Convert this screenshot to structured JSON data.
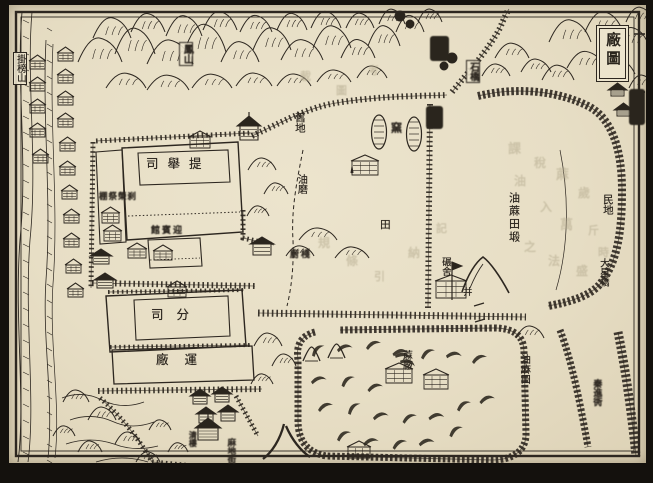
{
  "page": {
    "type": "woodblock-printed Chinese map, scanned book page",
    "paper_color": "#e9e1c8",
    "ink_color": "#2d2720",
    "title_box": {
      "text": "廠圖",
      "note": "map title cartouche, top-right corner"
    }
  },
  "labels": [
    {
      "id": "label-guabang-mountain",
      "t": "掛榜山",
      "x": 13,
      "y": 52,
      "o": "v",
      "s": 9.5,
      "box": true
    },
    {
      "id": "label-mountain-cartouche",
      "t": "鳳山",
      "x": 179,
      "y": 42,
      "o": "v",
      "s": 10,
      "box": true,
      "blur": true
    },
    {
      "id": "label-old-land",
      "t": "舊地",
      "x": 294,
      "y": 112,
      "o": "v",
      "s": 10.5
    },
    {
      "id": "label-oil-mill",
      "t": "油磨",
      "x": 295,
      "y": 174,
      "o": "v",
      "s": 10
    },
    {
      "id": "label-kiln",
      "t": "窯",
      "x": 390,
      "y": 122,
      "o": "v",
      "s": 11,
      "blur": true
    },
    {
      "id": "label-sesame-field-tract",
      "t": "油蔴田塅",
      "x": 508,
      "y": 192,
      "o": "v",
      "s": 11,
      "ls": 2
    },
    {
      "id": "label-roller-shed",
      "t": "碾舍",
      "x": 440,
      "y": 257,
      "o": "v",
      "s": 9.5
    },
    {
      "id": "label-well",
      "t": "井",
      "x": 461,
      "y": 287,
      "o": "v",
      "s": 9
    },
    {
      "id": "label-civilian-land",
      "t": "民地",
      "x": 602,
      "y": 194,
      "o": "v",
      "s": 10.5
    },
    {
      "id": "label-daxing-bridge",
      "t": "大星橋",
      "x": 598,
      "y": 258,
      "o": "v",
      "s": 9.5
    },
    {
      "id": "label-field",
      "t": "田",
      "x": 379,
      "y": 219,
      "o": "v",
      "s": 10.5
    },
    {
      "id": "label-hemp-factory",
      "t": "蔴廠",
      "x": 400,
      "y": 350,
      "o": "v",
      "s": 10
    },
    {
      "id": "label-sesame-field",
      "t": "油麻田",
      "x": 518,
      "y": 354,
      "o": "v",
      "s": 10
    },
    {
      "id": "label-qinjin-lane",
      "t": "秦進衖",
      "x": 591,
      "y": 379,
      "o": "v",
      "s": 9,
      "blur": true
    },
    {
      "id": "label-madi-street",
      "t": "麻地街",
      "x": 226,
      "y": 438,
      "o": "v",
      "s": 8.5,
      "blur": true
    },
    {
      "id": "label-ferry-tower",
      "t": "清樓",
      "x": 189,
      "y": 431,
      "o": "v",
      "s": 8,
      "blur": true
    },
    {
      "id": "label-tijusi-office",
      "t": "司舉提",
      "x": 146,
      "y": 157,
      "o": "h",
      "s": 12.5,
      "ls": 9
    },
    {
      "id": "label-guest-hall",
      "t": "館賓迎",
      "x": 151,
      "y": 227,
      "o": "h",
      "s": 9,
      "ls": 2,
      "blur": true
    },
    {
      "id": "label-annex-temple",
      "t": "棚祭榮刹",
      "x": 99,
      "y": 193,
      "o": "h",
      "s": 8.5,
      "ls": 1,
      "blur": true
    },
    {
      "id": "label-branch-office",
      "t": "司分",
      "x": 151,
      "y": 308,
      "o": "h",
      "s": 12.5,
      "ls": 13
    },
    {
      "id": "label-transport-factory",
      "t": "廠運",
      "x": 156,
      "y": 353,
      "o": "h",
      "s": 12.5,
      "ls": 16
    },
    {
      "id": "label-kitchen-shed",
      "t": "廚棧",
      "x": 290,
      "y": 251,
      "o": "h",
      "s": 9,
      "ls": 2,
      "blur": true
    },
    {
      "id": "label-bridge-cartouche",
      "t": "石橋",
      "x": 466,
      "y": 60,
      "o": "v",
      "s": 9.5,
      "box": true,
      "blur": true
    }
  ],
  "illegible_cartouches": [
    {
      "id": "cartouche-top-road",
      "x": 431,
      "y": 37,
      "w": 17,
      "h": 23
    },
    {
      "id": "cartouche-mid-road",
      "x": 427,
      "y": 107,
      "w": 15,
      "h": 21
    },
    {
      "id": "cartouche-northeast",
      "x": 630,
      "y": 90,
      "w": 14,
      "h": 34
    }
  ],
  "ghost_bleedthrough_text": [
    {
      "t": "課",
      "x": 508,
      "y": 138,
      "s": 13
    },
    {
      "t": "稅",
      "x": 534,
      "y": 154,
      "s": 12
    },
    {
      "t": "油",
      "x": 514,
      "y": 172,
      "s": 12
    },
    {
      "t": "蔴",
      "x": 556,
      "y": 164,
      "s": 13
    },
    {
      "t": "歲",
      "x": 578,
      "y": 184,
      "s": 12
    },
    {
      "t": "入",
      "x": 540,
      "y": 198,
      "s": 12
    },
    {
      "t": "萬",
      "x": 560,
      "y": 214,
      "s": 13
    },
    {
      "t": "斤",
      "x": 588,
      "y": 222,
      "s": 11
    },
    {
      "t": "之",
      "x": 524,
      "y": 238,
      "s": 12
    },
    {
      "t": "法",
      "x": 548,
      "y": 252,
      "s": 12
    },
    {
      "t": "盛",
      "x": 576,
      "y": 262,
      "s": 12
    },
    {
      "t": "時",
      "x": 598,
      "y": 244,
      "s": 11
    },
    {
      "t": "規",
      "x": 318,
      "y": 234,
      "s": 12
    },
    {
      "t": "條",
      "x": 346,
      "y": 252,
      "s": 12
    },
    {
      "t": "引",
      "x": 374,
      "y": 268,
      "s": 11
    },
    {
      "t": "納",
      "x": 408,
      "y": 244,
      "s": 12
    },
    {
      "t": "記",
      "x": 436,
      "y": 220,
      "s": 11
    },
    {
      "t": "載",
      "x": 300,
      "y": 68,
      "s": 11
    },
    {
      "t": "圖",
      "x": 336,
      "y": 82,
      "s": 11
    },
    {
      "t": "考",
      "x": 368,
      "y": 62,
      "s": 11
    }
  ],
  "map_features": [
    "mountain-range-top",
    "mountain-range-right",
    "river-left",
    "stream-left",
    "city-wall",
    "tiju-si-compound",
    "fensi-compound",
    "yunchang-building",
    "kilns",
    "sesame-field-enclosure",
    "sheaf-crescents",
    "watch-tower",
    "roads-ladder"
  ]
}
